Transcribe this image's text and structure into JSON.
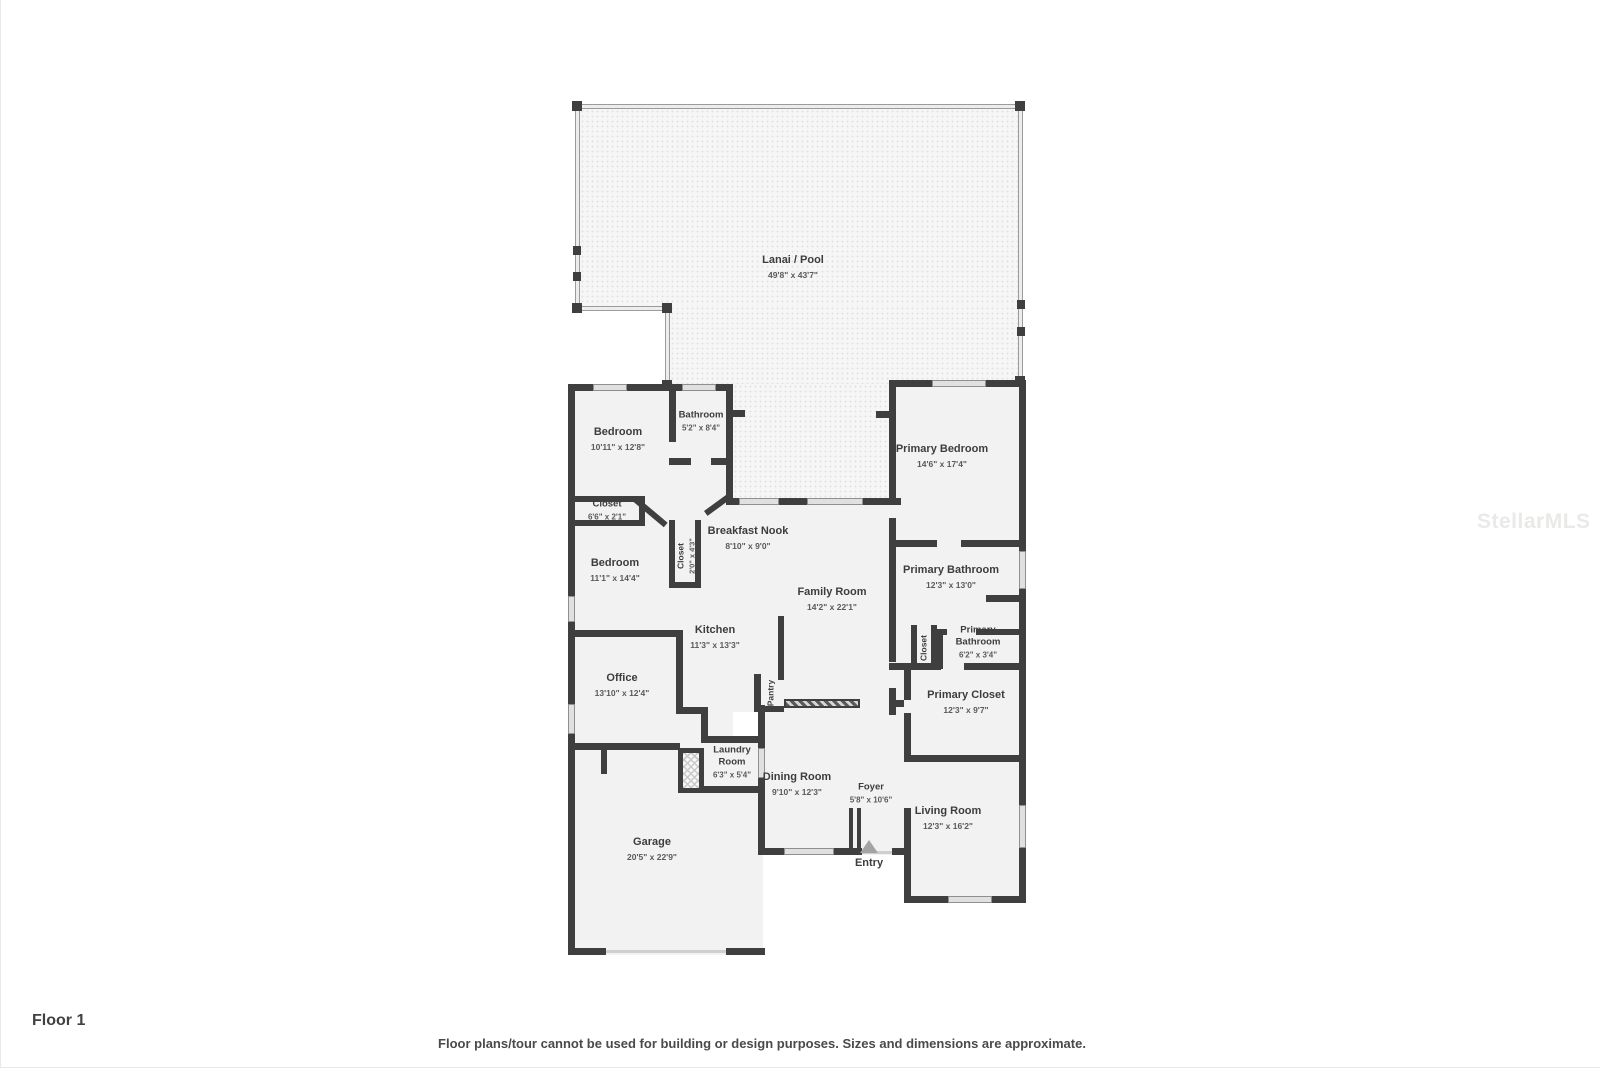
{
  "floor_label": "Floor 1",
  "disclaimer": "Floor plans/tour cannot be used for building or design purposes. Sizes and dimensions are approximate.",
  "watermark": "StellarMLS",
  "entry_label": "Entry",
  "colors": {
    "wall": "#3f3f3f",
    "room_fill": "#f2f2f2",
    "lanai_fill": "#f6f6f6"
  },
  "rooms": {
    "lanai": {
      "name": "Lanai / Pool",
      "dims": "49'8\" x 43'7\""
    },
    "bedroom1": {
      "name": "Bedroom",
      "dims": "10'11\" x 12'8\""
    },
    "bathroom": {
      "name": "Bathroom",
      "dims": "5'2\" x 8'4\""
    },
    "primary_bedroom": {
      "name": "Primary Bedroom",
      "dims": "14'6\" x 17'4\""
    },
    "closet1": {
      "name": "Closet",
      "dims": "6'6\" x 2'1\""
    },
    "bedroom2": {
      "name": "Bedroom",
      "dims": "11'1\" x 14'4\""
    },
    "closet2": {
      "name": "Closet",
      "dims": "2'0\" x 4'3\""
    },
    "breakfast_nook": {
      "name": "Breakfast Nook",
      "dims": "8'10\" x 9'0\""
    },
    "family_room": {
      "name": "Family Room",
      "dims": "14'2\" x 22'1\""
    },
    "kitchen": {
      "name": "Kitchen",
      "dims": "11'3\" x 13'3\""
    },
    "pantry": {
      "name": "Pantry",
      "dims": ""
    },
    "primary_bathroom": {
      "name": "Primary Bathroom",
      "dims": "12'3\" x 13'0\""
    },
    "closet3": {
      "name": "Closet",
      "dims": ""
    },
    "primary_bathroom2": {
      "name": "Primary Bathroom",
      "dims": "6'2\" x 3'4\""
    },
    "primary_closet": {
      "name": "Primary Closet",
      "dims": "12'3\" x 9'7\""
    },
    "office": {
      "name": "Office",
      "dims": "13'10\" x 12'4\""
    },
    "laundry": {
      "name": "Laundry Room",
      "dims": "6'3\" x 5'4\""
    },
    "dining": {
      "name": "Dining Room",
      "dims": "9'10\" x 12'3\""
    },
    "foyer": {
      "name": "Foyer",
      "dims": "5'8\" x 10'6\""
    },
    "living": {
      "name": "Living Room",
      "dims": "12'3\" x 16'2\""
    },
    "garage": {
      "name": "Garage",
      "dims": "20'5\" x 22'9\""
    }
  }
}
